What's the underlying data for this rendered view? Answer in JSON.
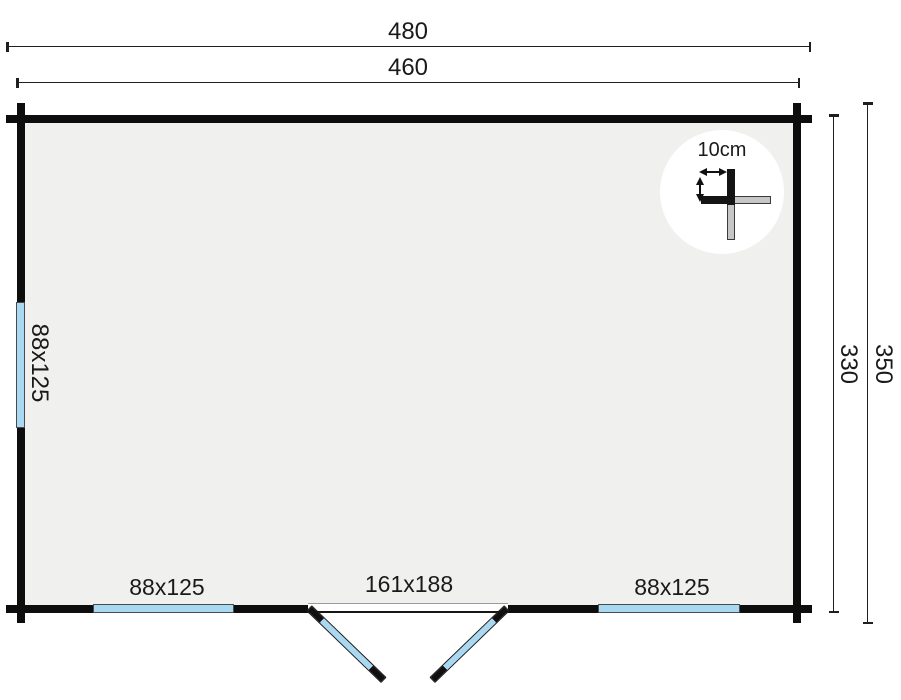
{
  "plan": {
    "type": "cabin-floor-plan",
    "dimensions": {
      "total_width": "480",
      "inner_width": "460",
      "inner_depth": "330",
      "total_depth": "350"
    },
    "windows": {
      "left_wall": "88x125",
      "bottom_left": "88x125",
      "bottom_right": "88x125"
    },
    "door": {
      "size": "161x188"
    },
    "wall_detail": {
      "thickness_label": "10cm"
    },
    "colors": {
      "wall": "#0d0d0d",
      "floor_fill": "#f0f0ef",
      "window_fill": "#a9d9f2",
      "detail_log_gray": "#c6c6c6",
      "dimension_line": "#1f1f1f"
    }
  }
}
